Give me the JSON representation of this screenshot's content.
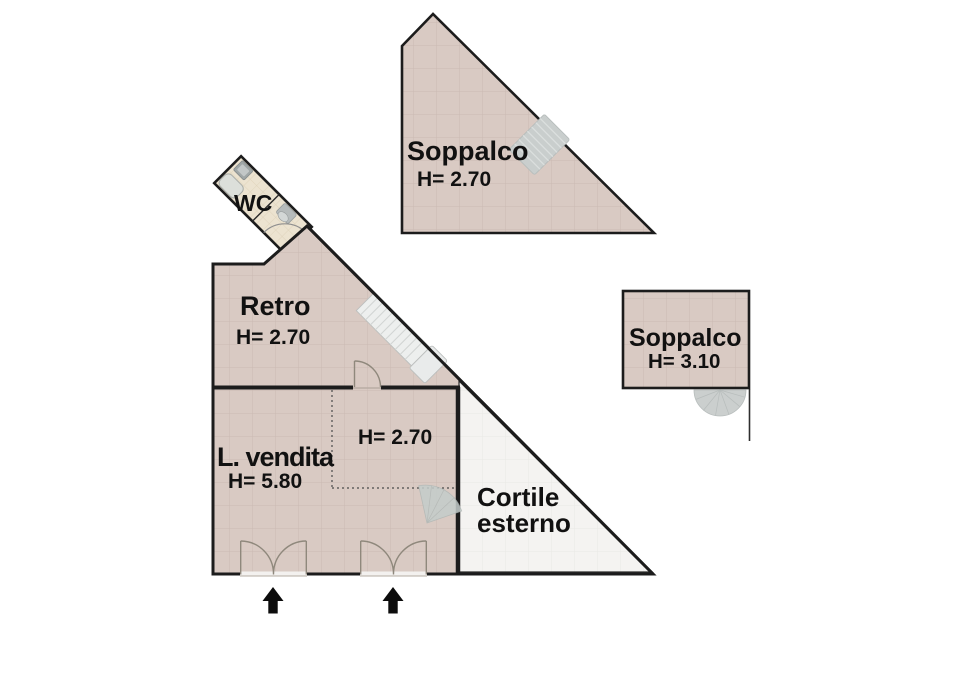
{
  "plan": {
    "areas": {
      "soppalco_top": {
        "name": "Soppalco",
        "height": "H= 2.70"
      },
      "soppalco_right": {
        "name": "Soppalco",
        "height": "H= 3.10"
      },
      "retro": {
        "name": "Retro",
        "height": "H= 2.70"
      },
      "wc": {
        "name": "WC"
      },
      "vendita": {
        "name": "L. vendita",
        "height": "H= 5.80"
      },
      "under_mezzanine": {
        "height": "H= 2.70"
      },
      "cortile": {
        "line1": "Cortile",
        "line2": "esterno"
      }
    },
    "colors": {
      "floor": "#d9cac3",
      "floor_grid": "#cbbab3",
      "wc_floor": "#ece3d0",
      "wc_grid": "#dcd0b6",
      "courtyard": "#f4f3f1",
      "courtyard_grid": "#e9e8e5",
      "wall": "#1c1c1c",
      "stairs_dark": "#c9cecd",
      "stairs_light": "#edefee",
      "fixture_gray": "#c6cac9",
      "door_line": "#8f887c",
      "text": "#111111"
    }
  }
}
